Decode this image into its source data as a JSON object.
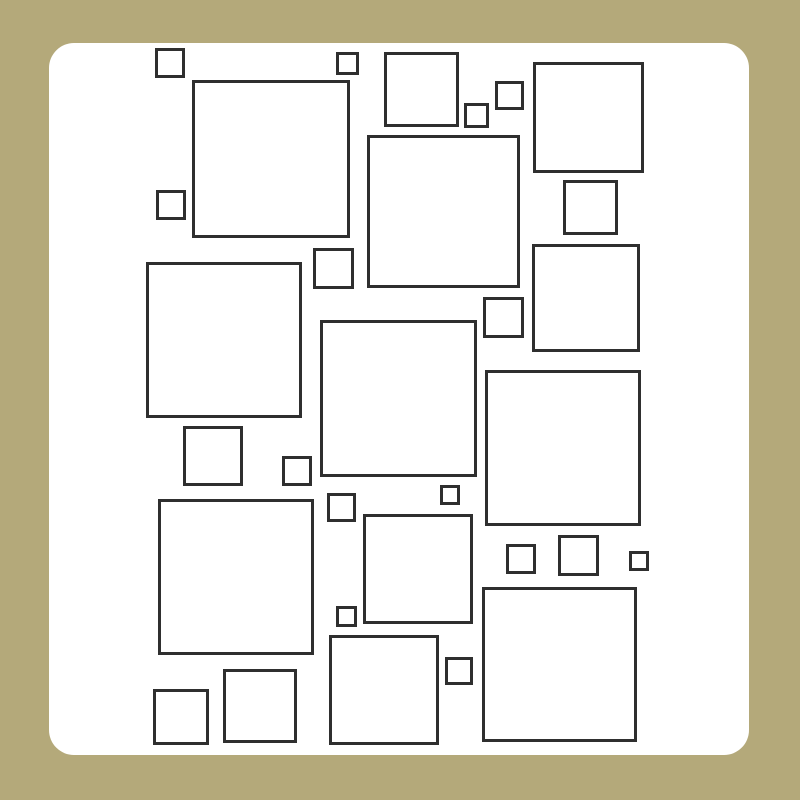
{
  "canvas": {
    "width": 800,
    "height": 800,
    "background_color": "#b4a97a"
  },
  "card": {
    "x": 49,
    "y": 43,
    "width": 700,
    "height": 712,
    "corner_radius": 25,
    "fill_color": "#ffffff"
  },
  "squares": {
    "stroke_color": "#2f2f2f",
    "stroke_width": 3,
    "fill_color": "#ffffff",
    "count": 31,
    "items": [
      {
        "x": 155,
        "y": 48,
        "size": 30
      },
      {
        "x": 336,
        "y": 52,
        "size": 23
      },
      {
        "x": 384,
        "y": 52,
        "size": 75
      },
      {
        "x": 533,
        "y": 62,
        "size": 111
      },
      {
        "x": 192,
        "y": 80,
        "size": 158
      },
      {
        "x": 495,
        "y": 81,
        "size": 29
      },
      {
        "x": 464,
        "y": 103,
        "size": 25
      },
      {
        "x": 367,
        "y": 135,
        "size": 153
      },
      {
        "x": 563,
        "y": 180,
        "size": 55
      },
      {
        "x": 156,
        "y": 190,
        "size": 30
      },
      {
        "x": 532,
        "y": 244,
        "size": 108
      },
      {
        "x": 313,
        "y": 248,
        "size": 41
      },
      {
        "x": 146,
        "y": 262,
        "size": 156
      },
      {
        "x": 483,
        "y": 297,
        "size": 41
      },
      {
        "x": 320,
        "y": 320,
        "size": 157
      },
      {
        "x": 485,
        "y": 370,
        "size": 156
      },
      {
        "x": 183,
        "y": 426,
        "size": 60
      },
      {
        "x": 282,
        "y": 456,
        "size": 30
      },
      {
        "x": 440,
        "y": 485,
        "size": 20
      },
      {
        "x": 327,
        "y": 493,
        "size": 29
      },
      {
        "x": 158,
        "y": 499,
        "size": 156
      },
      {
        "x": 363,
        "y": 514,
        "size": 110
      },
      {
        "x": 558,
        "y": 535,
        "size": 41
      },
      {
        "x": 506,
        "y": 544,
        "size": 30
      },
      {
        "x": 629,
        "y": 551,
        "size": 20
      },
      {
        "x": 482,
        "y": 587,
        "size": 155
      },
      {
        "x": 336,
        "y": 606,
        "size": 21
      },
      {
        "x": 329,
        "y": 635,
        "size": 110
      },
      {
        "x": 445,
        "y": 657,
        "size": 28
      },
      {
        "x": 223,
        "y": 669,
        "size": 74
      },
      {
        "x": 153,
        "y": 689,
        "size": 56
      }
    ]
  }
}
